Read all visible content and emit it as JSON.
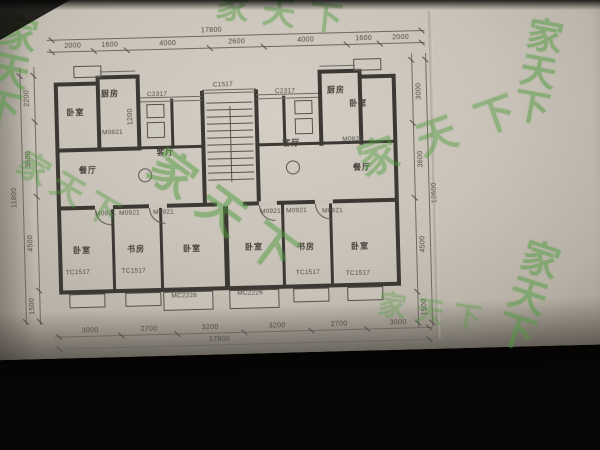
{
  "photo": {
    "paper_color": "#c8c2b8",
    "line_color": "#3c3833",
    "dim_text_color": "#4e4a43",
    "watermark_color": "#4f9c3e",
    "background_color": "#070605"
  },
  "watermark": {
    "text": "家天下",
    "color": "#4f9c3e",
    "instances": [
      {
        "x": -6,
        "y": 20,
        "size": 38,
        "rot": 14,
        "vertical": true,
        "op": 0.5
      },
      {
        "x": 232,
        "y": 2,
        "size": 33,
        "rot": 8,
        "ls": 14,
        "op": 0.45
      },
      {
        "x": 524,
        "y": 38,
        "size": 36,
        "rot": 12,
        "vertical": true,
        "op": 0.5
      },
      {
        "x": 366,
        "y": 120,
        "size": 40,
        "rot": -18,
        "ls": 22,
        "op": 0.45
      },
      {
        "x": 148,
        "y": 194,
        "size": 46,
        "rot": 38,
        "ls": 16,
        "op": 0.5
      },
      {
        "x": 24,
        "y": 176,
        "size": 32,
        "rot": 32,
        "ls": 8,
        "op": 0.4
      },
      {
        "x": 506,
        "y": 258,
        "size": 38,
        "rot": 20,
        "vertical": true,
        "op": 0.5
      },
      {
        "x": 386,
        "y": 310,
        "size": 28,
        "rot": 10,
        "ls": 10,
        "op": 0.35
      }
    ]
  },
  "dimensions": {
    "top_total": "17800",
    "top_segments": [
      "2000",
      "1600",
      "4000",
      "2600",
      "4000",
      "1600",
      "2000"
    ],
    "bottom_segments": [
      "3000",
      "2700",
      "3200",
      "3200",
      "2700",
      "3000"
    ],
    "bottom_total": "17800",
    "left_segments": [
      "2200",
      "3600",
      "4500",
      "1500"
    ],
    "left_total": "11800",
    "right_segments": [
      "3000",
      "3600",
      "4500",
      "1500"
    ],
    "right_total": "12600",
    "inner_segments": [
      "1200"
    ]
  },
  "plan": {
    "room_labels": [
      {
        "text": "卧室",
        "x": 68,
        "y": 101
      },
      {
        "text": "厨房",
        "x": 103,
        "y": 83
      },
      {
        "text": "餐厅",
        "x": 79,
        "y": 159
      },
      {
        "text": "客厅",
        "x": 157,
        "y": 143
      },
      {
        "text": "客厅",
        "x": 283,
        "y": 137
      },
      {
        "text": "餐厅",
        "x": 353,
        "y": 163
      },
      {
        "text": "厨房",
        "x": 329,
        "y": 85
      },
      {
        "text": "卧室",
        "x": 351,
        "y": 99
      },
      {
        "text": "卧室",
        "x": 71,
        "y": 239
      },
      {
        "text": "书房",
        "x": 125,
        "y": 239
      },
      {
        "text": "卧室",
        "x": 181,
        "y": 240
      },
      {
        "text": "卧室",
        "x": 243,
        "y": 240
      },
      {
        "text": "书房",
        "x": 295,
        "y": 241
      },
      {
        "text": "卧室",
        "x": 349,
        "y": 242
      }
    ],
    "tag_labels": [
      {
        "text": "C2317",
        "x": 149,
        "y": 87
      },
      {
        "text": "C2317",
        "x": 277,
        "y": 87
      },
      {
        "text": "C1517",
        "x": 215,
        "y": 79
      },
      {
        "text": "M0821",
        "x": 103,
        "y": 124
      },
      {
        "text": "M0821",
        "x": 343,
        "y": 137
      },
      {
        "text": "M0921",
        "x": 94,
        "y": 205
      },
      {
        "text": "M0921",
        "x": 118,
        "y": 205
      },
      {
        "text": "M0921",
        "x": 152,
        "y": 205
      },
      {
        "text": "M0921",
        "x": 259,
        "y": 207
      },
      {
        "text": "M0921",
        "x": 285,
        "y": 207
      },
      {
        "text": "M0921",
        "x": 321,
        "y": 208
      },
      {
        "text": "TC1517",
        "x": 63,
        "y": 263
      },
      {
        "text": "TC1517",
        "x": 119,
        "y": 263
      },
      {
        "text": "TC1517",
        "x": 293,
        "y": 269
      },
      {
        "text": "TC1517",
        "x": 343,
        "y": 271
      },
      {
        "text": "MC2226",
        "x": 168,
        "y": 289
      },
      {
        "text": "MC2226",
        "x": 234,
        "y": 288
      }
    ],
    "dim_labels": [
      {
        "text": "17800",
        "x": 215,
        "y": 28
      },
      {
        "text": "2000",
        "x": 76,
        "y": 40
      },
      {
        "text": "1600",
        "x": 113,
        "y": 40
      },
      {
        "text": "4000",
        "x": 171,
        "y": 40
      },
      {
        "text": "2600",
        "x": 240,
        "y": 40
      },
      {
        "text": "4000",
        "x": 309,
        "y": 40
      },
      {
        "text": "1600",
        "x": 367,
        "y": 40
      },
      {
        "text": "2000",
        "x": 404,
        "y": 40
      },
      {
        "text": "3000",
        "x": 86,
        "y": 325
      },
      {
        "text": "2700",
        "x": 145,
        "y": 325
      },
      {
        "text": "3200",
        "x": 206,
        "y": 325
      },
      {
        "text": "3200",
        "x": 273,
        "y": 325
      },
      {
        "text": "2700",
        "x": 335,
        "y": 325
      },
      {
        "text": "3000",
        "x": 394,
        "y": 325
      },
      {
        "text": "17800",
        "x": 215,
        "y": 337
      },
      {
        "text": "2200",
        "x": 29,
        "y": 91,
        "rot": -90
      },
      {
        "text": "3600",
        "x": 29,
        "y": 152,
        "rot": -90
      },
      {
        "text": "4500",
        "x": 29,
        "y": 236,
        "rot": -90
      },
      {
        "text": "1500",
        "x": 29,
        "y": 299,
        "rot": -90
      },
      {
        "text": "11800",
        "x": 14,
        "y": 190,
        "rot": -90
      },
      {
        "text": "3000",
        "x": 421,
        "y": 94,
        "rot": -90
      },
      {
        "text": "3600",
        "x": 421,
        "y": 162,
        "rot": -90
      },
      {
        "text": "4500",
        "x": 421,
        "y": 247,
        "rot": -90
      },
      {
        "text": "1500",
        "x": 421,
        "y": 310,
        "rot": -90
      },
      {
        "text": "12600",
        "x": 434,
        "y": 196,
        "rot": -90
      },
      {
        "text": "1200",
        "x": 132,
        "y": 112,
        "rot": -90
      }
    ]
  }
}
